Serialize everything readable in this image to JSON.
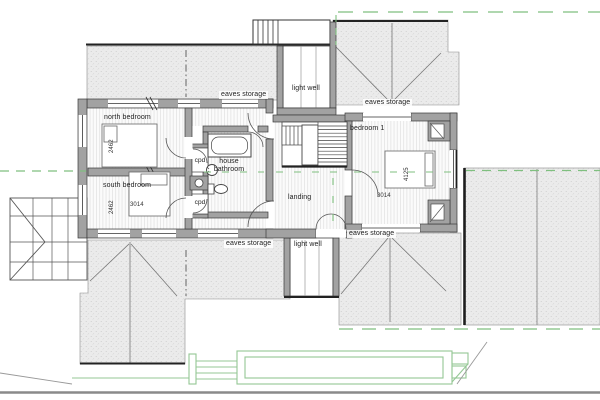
{
  "plan": {
    "labels": {
      "eaves_storage_nw": "eaves storage",
      "eaves_storage_ne": "eaves storage",
      "eaves_storage_sw": "eaves storage",
      "eaves_storage_se": "eaves storage",
      "light_well_north": "light well",
      "light_well_south": "light well",
      "north_bedroom": "north bedroom",
      "south_bedroom": "south bedroom",
      "bedroom_1": "bedroom 1",
      "house_bathroom_line1": "house",
      "house_bathroom_line2": "bathroom",
      "landing": "landing",
      "cpd_upper": "cpd",
      "cpd_lower": "cpd"
    },
    "dimensions": {
      "north_bedroom_depth": "2462",
      "south_bedroom_depth": "2462",
      "south_bedroom_width": "3014",
      "bedroom_1_width": "4125",
      "bedroom_1_length": "3014"
    },
    "colors": {
      "wall_fill": "#a2a2a2",
      "wall_outline": "#3a3a3a",
      "roof_hatch_base": "#ebebeb",
      "roof_hatch_dot": "#cbcbcb",
      "floor_hatch_line": "#e6e6e6",
      "green_axis": "#7fbf7f",
      "landscape_green": "#94c794",
      "ground_gray": "#8a8a8a",
      "text": "#222222"
    }
  }
}
